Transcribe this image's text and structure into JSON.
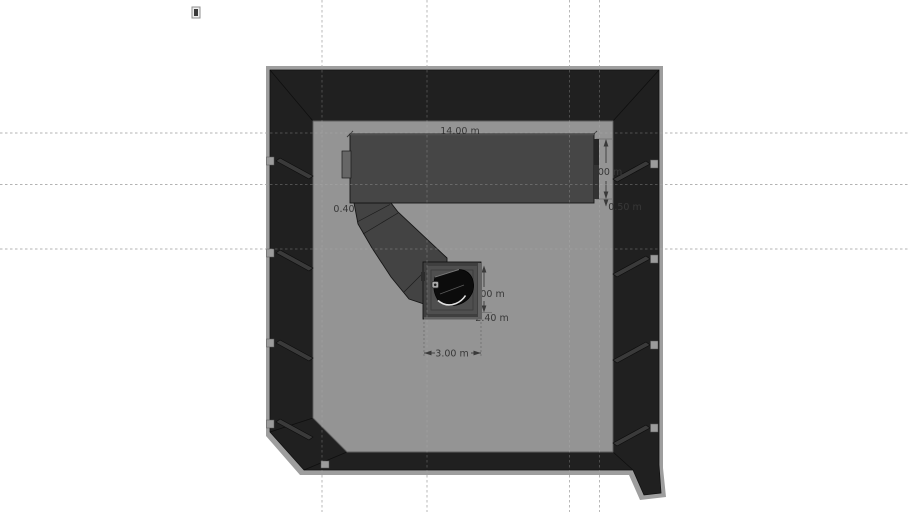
{
  "scene": {
    "title": "room-plan-top-view",
    "dimensions": {
      "stage_width": "14.00 m",
      "stage_depth": "4.00 m",
      "stage_offset": "0.50 m",
      "ramp_width": "0.40",
      "platform_height": "2.00 m",
      "platform_depth": "2.40 m",
      "platform_width": "3.00 m"
    },
    "objects": {
      "room": "room-walls",
      "stage": "stage-platform",
      "ramp": "access-ramp",
      "platform": "piano-platform",
      "piano": "grand-piano",
      "stool": "piano-stool"
    },
    "icons": {
      "top_marker": "small-component-marker"
    },
    "colors": {
      "background": "#ffffff",
      "floor": "#949494",
      "wall_dark": "#202020",
      "wall_edge": "#9e9e9e",
      "stage": "#464646",
      "ramp": "#434343",
      "platform": "#3f3f3f",
      "piano": "#0c0c0c",
      "guide": "#b3b3b3",
      "dim_text": "#383838"
    }
  }
}
